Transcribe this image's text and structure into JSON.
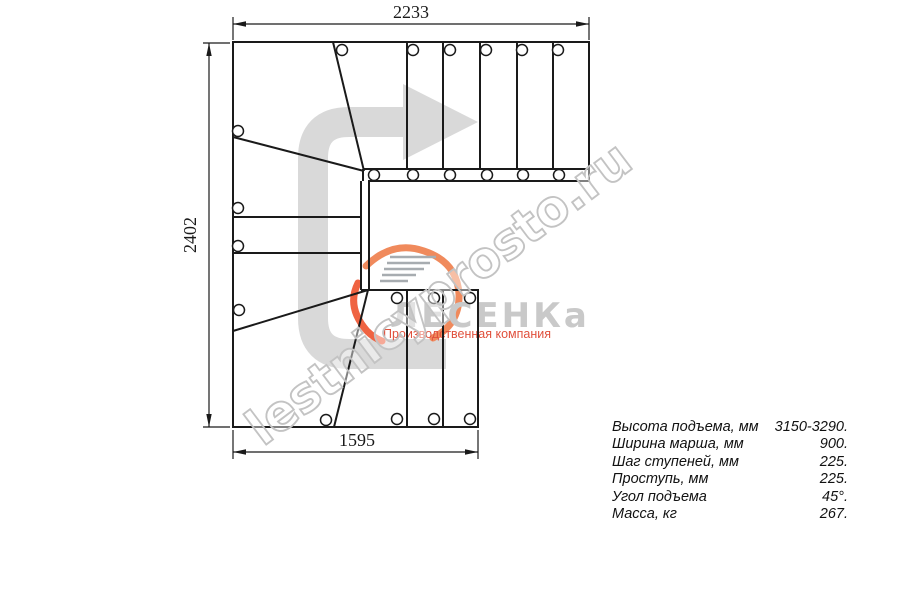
{
  "dimensions": {
    "width_top": "2233",
    "height_left": "2402",
    "width_bottom": "1595"
  },
  "watermark": {
    "text": "lestnicyprosto.ru"
  },
  "logo": {
    "brand": "ЛЕСЕНКа",
    "tagline": "Производственная компания",
    "accent_color": "#ee5a3c",
    "brand_color": "#c9c9c9"
  },
  "specs": {
    "rows": [
      {
        "label": "Высота подъема, мм",
        "value": "3150-3290."
      },
      {
        "label": "Ширина марша, мм",
        "value": "900."
      },
      {
        "label": "Шаг ступеней, мм",
        "value": "225."
      },
      {
        "label": "Проступь, мм",
        "value": "225."
      },
      {
        "label": "Угол подъема",
        "value": "45°."
      },
      {
        "label": "Масса, кг",
        "value": "267."
      }
    ]
  },
  "colors": {
    "line": "#1a1a1a",
    "arrow": "#d9d9d9",
    "watermark_stroke": "#c3c3c3"
  }
}
